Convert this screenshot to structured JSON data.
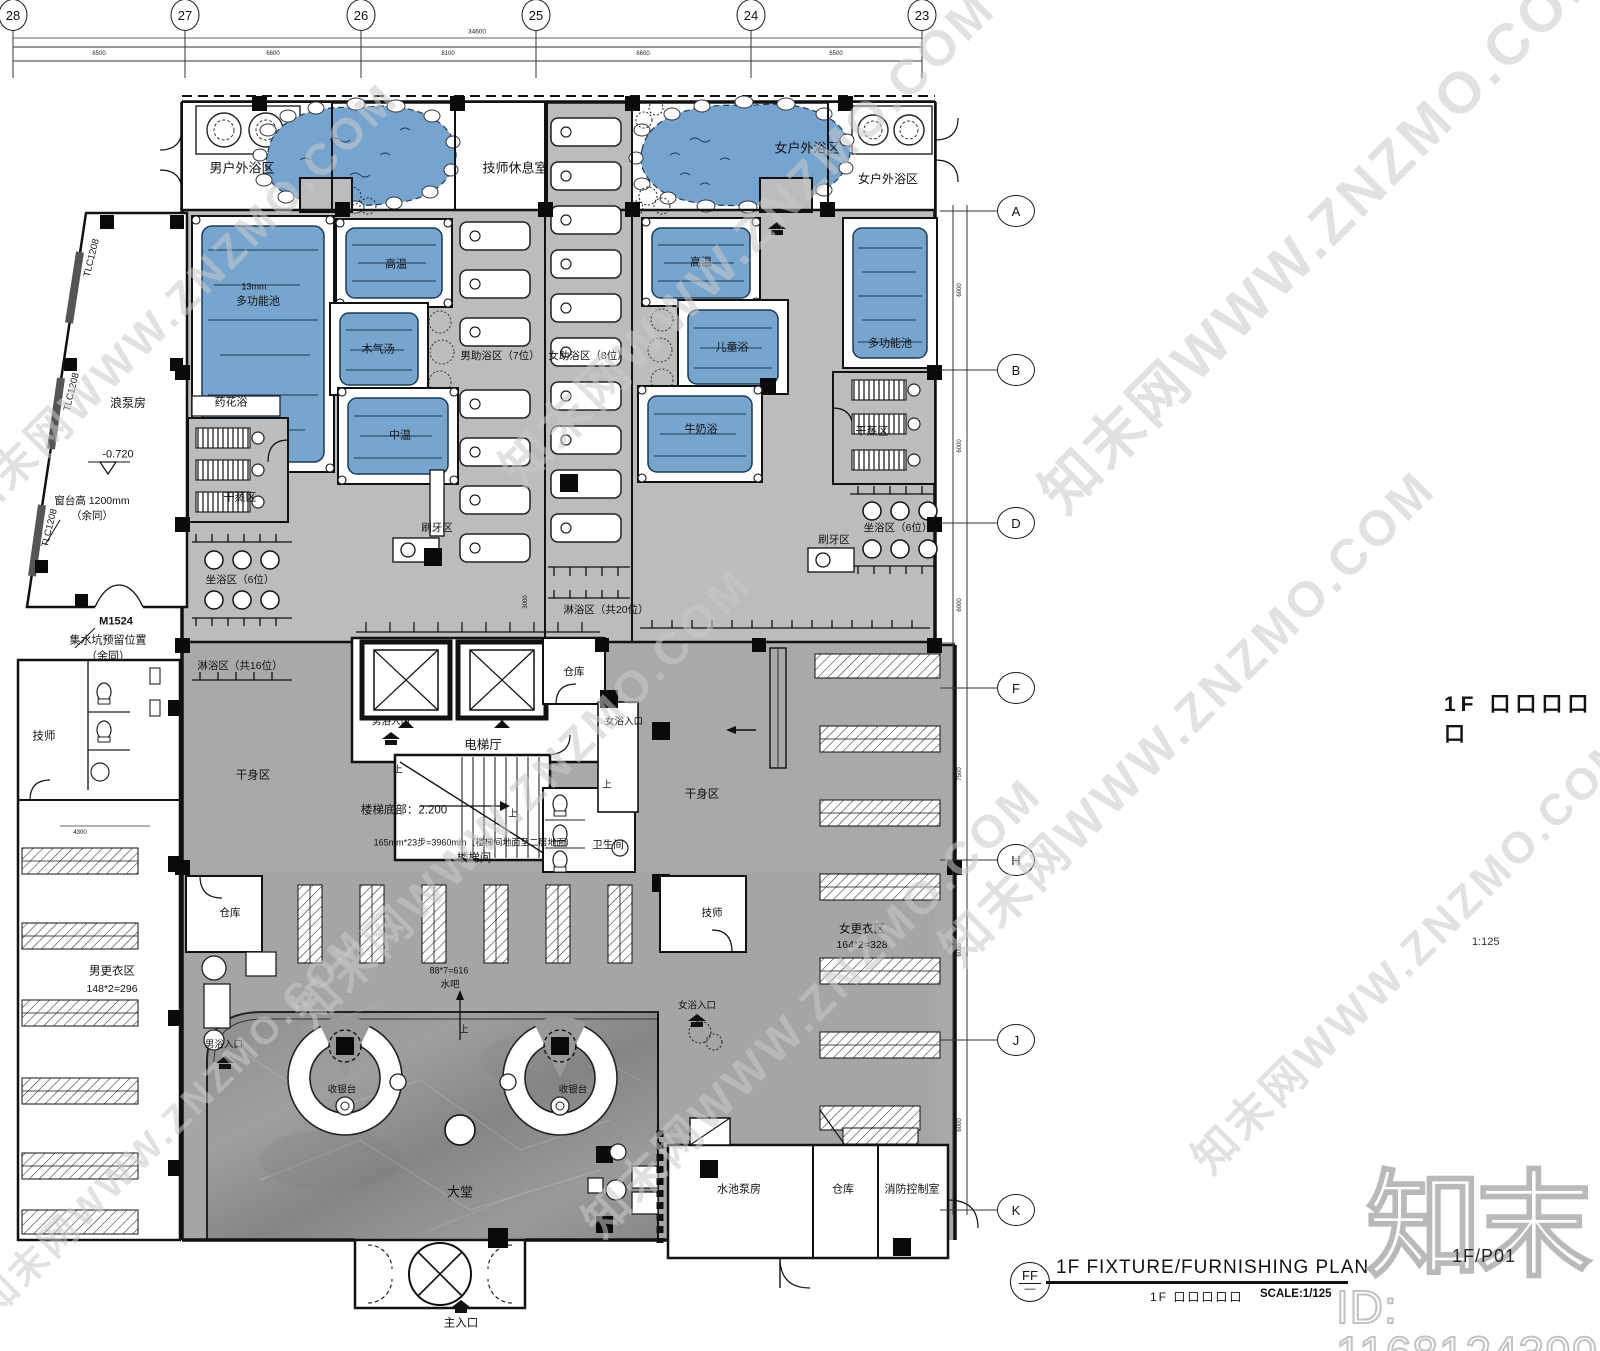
{
  "title_block": {
    "symbol": "FF",
    "symbol_sub": "—",
    "title": "1F FIXTURE/FURNISHING PLAN",
    "subtitle_cn": "1F 口口口口口",
    "scale": "SCALE:1/125"
  },
  "side_notes": {
    "plan_name_cn": "1F 口口口口口",
    "mid_scale": "1:125"
  },
  "watermark": {
    "diag_text": "知末网WWW.ZNZMO.COM",
    "logo": "知末",
    "id_text": "ID: 1168124399",
    "sheet_no": "1F/P01",
    "tiles": [
      {
        "x": 175,
        "y": 300,
        "fs": 44
      },
      {
        "x": 745,
        "y": 235,
        "fs": 50
      },
      {
        "x": 1320,
        "y": 225,
        "fs": 58
      },
      {
        "x": 1185,
        "y": 715,
        "fs": 50
      },
      {
        "x": 520,
        "y": 795,
        "fs": 46
      },
      {
        "x": 810,
        "y": 1005,
        "fs": 46
      },
      {
        "x": 1410,
        "y": 950,
        "fs": 44
      },
      {
        "x": 170,
        "y": 1120,
        "fs": 38
      }
    ]
  },
  "grid": {
    "top": [
      {
        "label": "28",
        "x": 13
      },
      {
        "label": "27",
        "x": 185
      },
      {
        "label": "26",
        "x": 361
      },
      {
        "label": "25",
        "x": 536
      },
      {
        "label": "24",
        "x": 751
      },
      {
        "label": "23",
        "x": 922
      }
    ],
    "top_total": "34600",
    "top_bays": [
      {
        "v": "6500",
        "x": 99
      },
      {
        "v": "6600",
        "x": 273
      },
      {
        "v": "8100",
        "x": 448
      },
      {
        "v": "6600",
        "x": 643
      },
      {
        "v": "6500",
        "x": 836
      }
    ],
    "right": [
      {
        "label": "A",
        "y": 211
      },
      {
        "label": "B",
        "y": 370
      },
      {
        "label": "D",
        "y": 523
      },
      {
        "label": "F",
        "y": 688
      },
      {
        "label": "H",
        "y": 860
      },
      {
        "label": "J",
        "y": 1040
      },
      {
        "label": "K",
        "y": 1210
      }
    ],
    "right_bays": [
      {
        "v": "6000",
        "y": 290
      },
      {
        "v": "6000",
        "y": 446
      },
      {
        "v": "6000",
        "y": 605
      },
      {
        "v": "7500",
        "y": 774
      },
      {
        "v": "6000",
        "y": 950
      },
      {
        "v": "6000",
        "y": 1125
      }
    ]
  },
  "labels": [
    {
      "n": "zone-men-outdoor-label",
      "t": "男户外浴区",
      "x": 242,
      "y": 168,
      "fs": 13
    },
    {
      "n": "room-tech-rest-label",
      "t": "技师休息室",
      "x": 515,
      "y": 168,
      "fs": 13
    },
    {
      "n": "zone-women-outdoor-pond-label",
      "t": "女户外浴区",
      "x": 807,
      "y": 148,
      "fs": 13
    },
    {
      "n": "zone-women-outdoor-label",
      "t": "女户外浴区",
      "x": 888,
      "y": 179,
      "fs": 12
    },
    {
      "n": "pool-depth-note",
      "t": "13mm",
      "x": 254,
      "y": 287,
      "fs": 9
    },
    {
      "n": "pool-multi-left-label",
      "t": "多功能池",
      "x": 258,
      "y": 302,
      "fs": 11
    },
    {
      "n": "pool-high-left-label",
      "t": "高温",
      "x": 396,
      "y": 265,
      "fs": 11
    },
    {
      "n": "pool-wood-label",
      "t": "木气汤",
      "x": 378,
      "y": 350,
      "fs": 11
    },
    {
      "n": "pool-mid-label",
      "t": "中温",
      "x": 400,
      "y": 436,
      "fs": 11
    },
    {
      "n": "pool-high-right-label",
      "t": "高温",
      "x": 701,
      "y": 263,
      "fs": 11
    },
    {
      "n": "pool-children-label",
      "t": "儿童浴",
      "x": 732,
      "y": 348,
      "fs": 11
    },
    {
      "n": "pool-milk-label",
      "t": "牛奶浴",
      "x": 701,
      "y": 430,
      "fs": 11
    },
    {
      "n": "pool-multi-right-label",
      "t": "多功能池",
      "x": 890,
      "y": 344,
      "fs": 11
    },
    {
      "n": "zone-men-assist-label",
      "t": "男助浴区（7位）",
      "x": 500,
      "y": 356,
      "fs": 10.5
    },
    {
      "n": "zone-women-assist-label",
      "t": "女助浴区（8位）",
      "x": 588,
      "y": 356,
      "fs": 10.5
    },
    {
      "n": "room-flower-bath-label",
      "t": "药花浴",
      "x": 231,
      "y": 403,
      "fs": 11
    },
    {
      "n": "zone-dry-steam-left-label",
      "t": "干蒸区",
      "x": 240,
      "y": 498,
      "fs": 11
    },
    {
      "n": "zone-sit-left-label",
      "t": "坐浴区（6位）",
      "x": 240,
      "y": 580,
      "fs": 10.5
    },
    {
      "n": "zone-shower16-label",
      "t": "淋浴区（共16位）",
      "x": 240,
      "y": 666,
      "fs": 10.5
    },
    {
      "n": "zone-brush-center-label",
      "t": "刷牙区",
      "x": 437,
      "y": 528,
      "fs": 10.5
    },
    {
      "n": "zone-dry-steam-right-label",
      "t": "干蒸区",
      "x": 872,
      "y": 432,
      "fs": 11
    },
    {
      "n": "zone-sit-right-label",
      "t": "坐浴区（6位）",
      "x": 898,
      "y": 528,
      "fs": 10.5
    },
    {
      "n": "zone-brush-right-label",
      "t": "刷牙区",
      "x": 834,
      "y": 540,
      "fs": 10.5
    },
    {
      "n": "zone-shower20-label",
      "t": "淋浴区（共20位）",
      "x": 606,
      "y": 610,
      "fs": 10.5
    },
    {
      "n": "room-pump-label",
      "t": "浪泵房",
      "x": 128,
      "y": 403,
      "fs": 12
    },
    {
      "n": "level-note",
      "t": "-0.720",
      "x": 118,
      "y": 455,
      "fs": 11
    },
    {
      "n": "sill-note-1",
      "t": "窗台高 1200mm",
      "x": 92,
      "y": 501,
      "fs": 10.5
    },
    {
      "n": "sill-note-2",
      "t": "（余同）",
      "x": 92,
      "y": 516,
      "fs": 10.5
    },
    {
      "n": "door-m1524-label",
      "t": "M1524",
      "x": 116,
      "y": 622,
      "fs": 11,
      "b": 1
    },
    {
      "n": "sump-note-1",
      "t": "集水坑预留位置",
      "x": 108,
      "y": 641,
      "fs": 11
    },
    {
      "n": "sump-note-2",
      "t": "（余同）",
      "x": 108,
      "y": 657,
      "fs": 11
    },
    {
      "n": "window-tlc-1",
      "t": "TLC1208",
      "x": 92,
      "y": 258,
      "fs": 9.5,
      "rot": -76
    },
    {
      "n": "window-tlc-2",
      "t": "TLC1208",
      "x": 72,
      "y": 392,
      "fs": 9.5,
      "rot": -76
    },
    {
      "n": "window-tlc-3",
      "t": "TLC1208",
      "x": 50,
      "y": 528,
      "fs": 9.5,
      "rot": -76
    },
    {
      "n": "room-storage-mid-label",
      "t": "仓库",
      "x": 574,
      "y": 672,
      "fs": 10.5
    },
    {
      "n": "hall-elevator-label",
      "t": "电梯厅",
      "x": 483,
      "y": 745,
      "fs": 12.5
    },
    {
      "n": "entry-men-mid-label",
      "t": "男浴入口",
      "x": 391,
      "y": 722,
      "fs": 9.5
    },
    {
      "n": "entry-women-mid-label",
      "t": "女浴入口",
      "x": 624,
      "y": 722,
      "fs": 9.5
    },
    {
      "n": "stair-bottom-note",
      "t": "楼梯底部：2.200",
      "x": 404,
      "y": 811,
      "fs": 11.5
    },
    {
      "n": "stair-calc-note",
      "t": "165mm*23步=3960mm（楼梯间地面至二层地面）",
      "x": 474,
      "y": 843,
      "fs": 9
    },
    {
      "n": "room-stair-label",
      "t": "楼梯间",
      "x": 474,
      "y": 859,
      "fs": 11.5
    },
    {
      "n": "room-wc-label",
      "t": "卫生间",
      "x": 608,
      "y": 845,
      "fs": 10.5
    },
    {
      "n": "zone-dry-body-left-label",
      "t": "干身区",
      "x": 253,
      "y": 776,
      "fs": 11.5
    },
    {
      "n": "zone-dry-body-right-label",
      "t": "干身区",
      "x": 702,
      "y": 795,
      "fs": 11.5
    },
    {
      "n": "room-tech-left-label",
      "t": "技师",
      "x": 44,
      "y": 737,
      "fs": 11.5
    },
    {
      "n": "zone-men-locker-label",
      "t": "男更衣区",
      "x": 112,
      "y": 972,
      "fs": 11.5
    },
    {
      "n": "zone-men-locker-calc",
      "t": "148*2=296",
      "x": 112,
      "y": 989,
      "fs": 10.5
    },
    {
      "n": "room-storage-bl-label",
      "t": "仓库",
      "x": 230,
      "y": 913,
      "fs": 10.5
    },
    {
      "n": "room-tech-right-label",
      "t": "技师",
      "x": 712,
      "y": 913,
      "fs": 10.5
    },
    {
      "n": "zone-women-locker-label",
      "t": "女更衣区",
      "x": 862,
      "y": 930,
      "fs": 11.5
    },
    {
      "n": "zone-women-locker-calc",
      "t": "164*2=328",
      "x": 862,
      "y": 945,
      "fs": 10.5
    },
    {
      "n": "bar-calc-note",
      "t": "88*7=616",
      "x": 449,
      "y": 971,
      "fs": 9
    },
    {
      "n": "bar-label",
      "t": "水吧",
      "x": 450,
      "y": 985,
      "fs": 9.5
    },
    {
      "n": "entry-men-hall-label",
      "t": "男浴入口",
      "x": 224,
      "y": 1045,
      "fs": 9.5
    },
    {
      "n": "entry-women-hall-label",
      "t": "女浴入口",
      "x": 697,
      "y": 1006,
      "fs": 9.5
    },
    {
      "n": "desk-left-label",
      "t": "收银台",
      "x": 342,
      "y": 1090,
      "fs": 9.5
    },
    {
      "n": "desk-right-label",
      "t": "收银台",
      "x": 573,
      "y": 1090,
      "fs": 9.5
    },
    {
      "n": "lobby-label",
      "t": "大堂",
      "x": 460,
      "y": 1192,
      "fs": 13
    },
    {
      "n": "entrance-main-label",
      "t": "主入口",
      "x": 461,
      "y": 1324,
      "fs": 11.5
    },
    {
      "n": "room-pool-pump-label",
      "t": "水池泵房",
      "x": 739,
      "y": 1190,
      "fs": 11
    },
    {
      "n": "room-storage-br-label",
      "t": "仓库",
      "x": 843,
      "y": 1190,
      "fs": 11
    },
    {
      "n": "room-fire-ctrl-label",
      "t": "消防控制室",
      "x": 912,
      "y": 1190,
      "fs": 11
    },
    {
      "n": "up-mark-1",
      "t": "上",
      "x": 398,
      "y": 770,
      "fs": 9.5
    },
    {
      "n": "up-mark-2",
      "t": "上",
      "x": 513,
      "y": 814,
      "fs": 9.5
    },
    {
      "n": "up-mark-3",
      "t": "上",
      "x": 607,
      "y": 785,
      "fs": 9.5
    },
    {
      "n": "up-mark-4",
      "t": "上",
      "x": 464,
      "y": 1030,
      "fs": 9.5
    },
    {
      "n": "dim-4300",
      "t": "4300",
      "x": 80,
      "y": 833,
      "fs": 6
    },
    {
      "n": "dim-3000",
      "t": "3000",
      "x": 526,
      "y": 602,
      "fs": 6,
      "rot": -90
    }
  ]
}
